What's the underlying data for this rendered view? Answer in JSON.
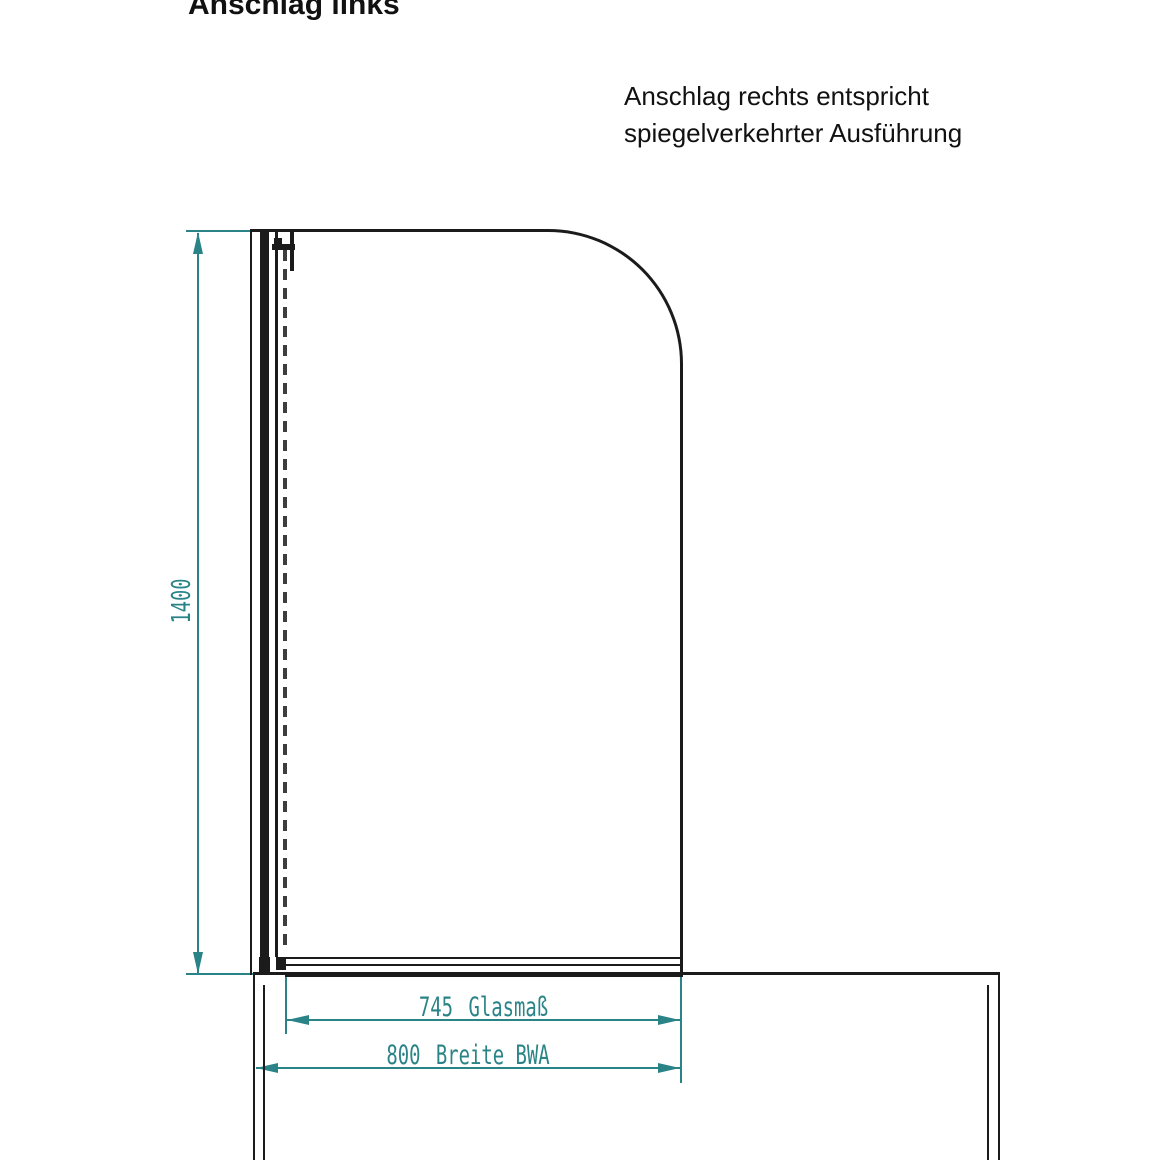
{
  "title": "Anschlag links",
  "note": {
    "line1": "Anschlag rechts entspricht",
    "line2": "spiegelverkehrter Ausführung"
  },
  "dimensions": {
    "height": {
      "value": "1400"
    },
    "glass_width": {
      "value": "745",
      "label": "Glasmaß"
    },
    "overall_width": {
      "value": "800",
      "label": "Breite BWA"
    }
  },
  "colors": {
    "dimension_teal": "#2a8487",
    "drawing_black": "#1b1b1b"
  }
}
